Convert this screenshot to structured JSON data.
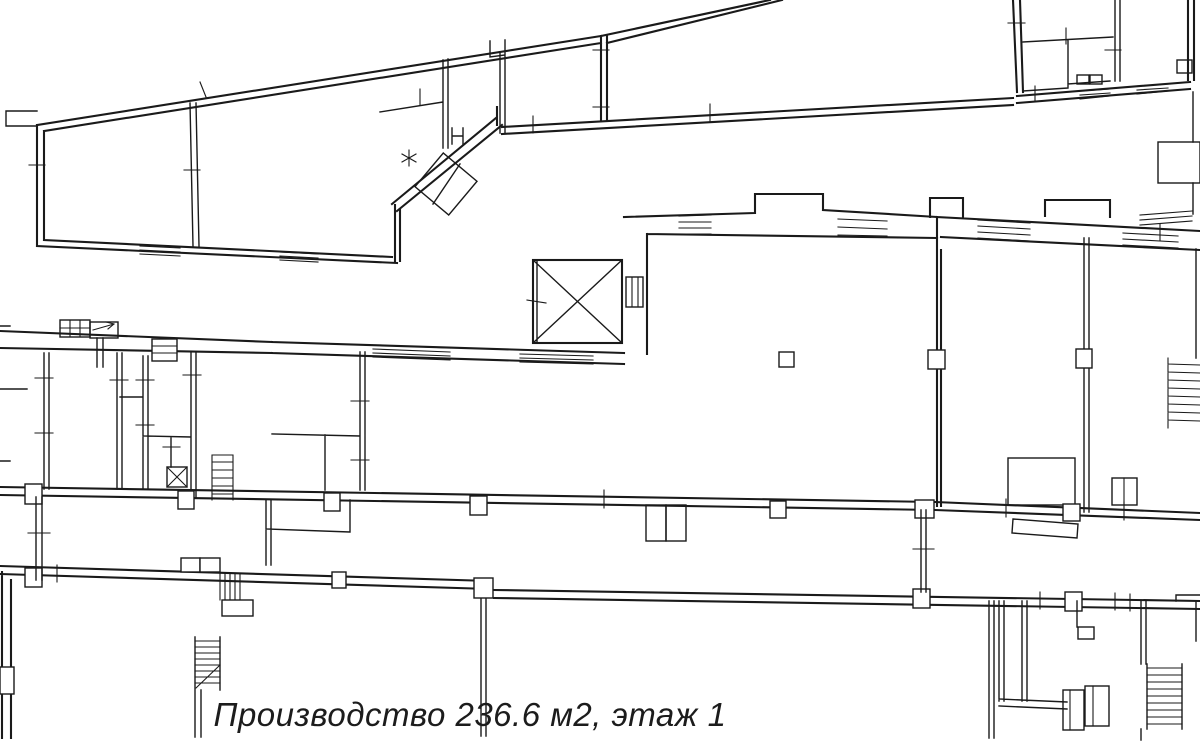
{
  "page": {
    "background": "#ffffff"
  },
  "plan": {
    "wall_color": "#1a1a1a"
  },
  "highlight": {
    "fill": "#f03c46",
    "opacity": "0.44",
    "points": "272,342 624,353 624,217 755,212 755,194 823,194 823,210 937,217 935,503 272,489",
    "room_type": "Производство",
    "area": "236.6 м2",
    "floor": "этаж 1"
  },
  "caption": {
    "text": "Производство 236.6 м2, этаж 1"
  }
}
